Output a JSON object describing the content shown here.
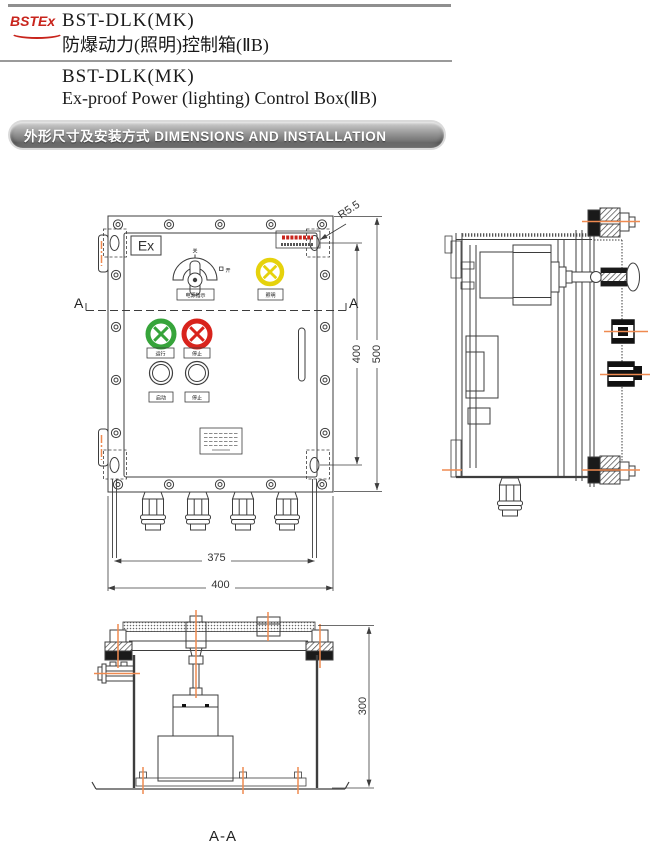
{
  "header": {
    "logo": "BSTEx",
    "model_line1": "BST-DLK(MK)",
    "title_cn": "防爆动力(照明)控制箱(ⅡB)",
    "model_line2": "BST-DLK(MK)",
    "title_en": "Ex-proof Power (lighting) Control Box(ⅡB)",
    "banner": "外形尺寸及安装方式 DIMENSIONS AND INSTALLATION"
  },
  "front_view": {
    "ex_mark": "Ex",
    "selector": {
      "label": "电源指示",
      "mark_off": "关",
      "mark_on": "开"
    },
    "lamps": {
      "yellow_label": "照明",
      "green_label": "运行",
      "red_label": "停止"
    },
    "buttons": {
      "start_label": "启动",
      "stop_label": "停止"
    },
    "section_marker_left": "A",
    "section_marker_right": "A",
    "dims": {
      "corner_radius": "R5.5",
      "inner_height": "400",
      "outer_height": "500",
      "inner_width": "375",
      "outer_width": "400"
    }
  },
  "section_view": {
    "title": "A-A",
    "dim_depth": "300"
  },
  "colors": {
    "accent_red": "#c8241c",
    "lamp_yellow": "#e6d20c",
    "lamp_green": "#36a43a",
    "lamp_red": "#d8231c",
    "centerline_orange": "#ef8a50",
    "line": "#3d3d3d"
  }
}
